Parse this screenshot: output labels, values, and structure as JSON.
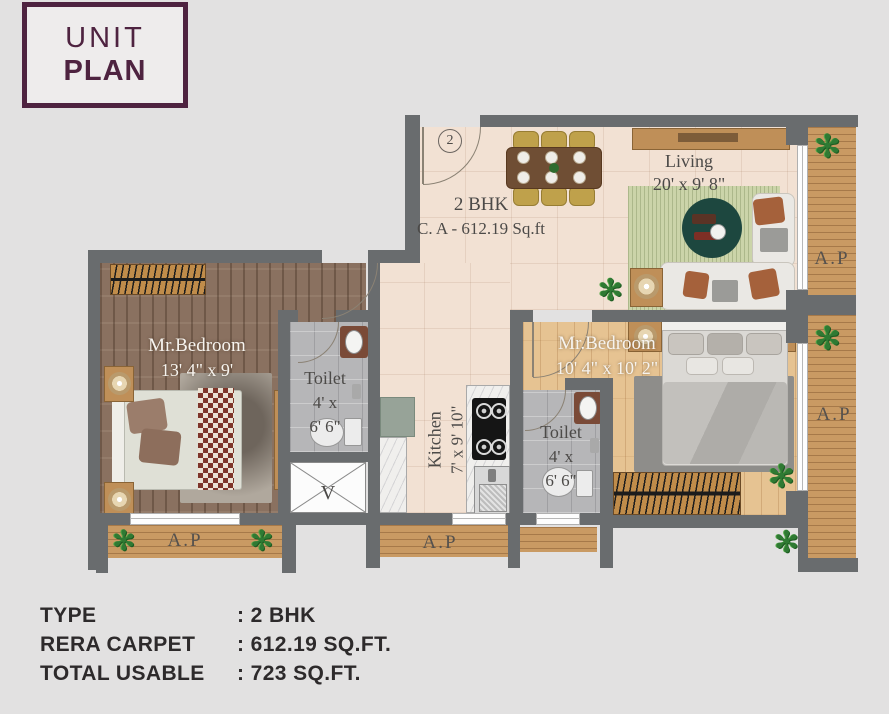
{
  "colors": {
    "brand_maroon": "#4e2340",
    "wall_gray": "#696c6e",
    "deck_wood": "#c99a63",
    "hall_floor": "#f2e1d3",
    "bedroom1_floor": "#8a7160",
    "bedroom2_floor": "#e6c392",
    "toilet_floor": "#b6b6b8",
    "rug_green": "#cbd4a9",
    "page_bg": "#e2e1e1"
  },
  "logo": {
    "line1": "UNIT",
    "line2": "PLAN"
  },
  "plan": {
    "entrance_number": "2",
    "unit_label": {
      "line1": "2 BHK",
      "line2": "C. A - 612.19 Sq.ft"
    },
    "rooms": {
      "living": {
        "name": "Living",
        "dim": "20' x 9' 8\""
      },
      "bedroom1": {
        "name": "Mr.Bedroom",
        "dim": "13' 4\" x 9'"
      },
      "bedroom2": {
        "name": "Mr.Bedroom",
        "dim": "10' 4\" x 10' 2\""
      },
      "toilet1": {
        "name": "Toilet",
        "dim_line1": "4' x",
        "dim_line2": "6' 6\""
      },
      "toilet2": {
        "name": "Toilet",
        "dim_line1": "4' x",
        "dim_line2": "6' 6\""
      },
      "kitchen": {
        "name": "Kitchen",
        "dim": "7' x 9' 10\""
      }
    },
    "balconies": {
      "right_top": "A.P",
      "right_bottom": "A.P",
      "bottom_left": "A.P",
      "bottom_center": "A.P"
    },
    "shaft_label": "V"
  },
  "summary": {
    "rows": [
      {
        "label": "TYPE",
        "value": ": 2 BHK"
      },
      {
        "label": "RERA CARPET",
        "value": ": 612.19 SQ.FT."
      },
      {
        "label": "TOTAL USABLE",
        "value": ": 723 SQ.FT."
      }
    ]
  }
}
